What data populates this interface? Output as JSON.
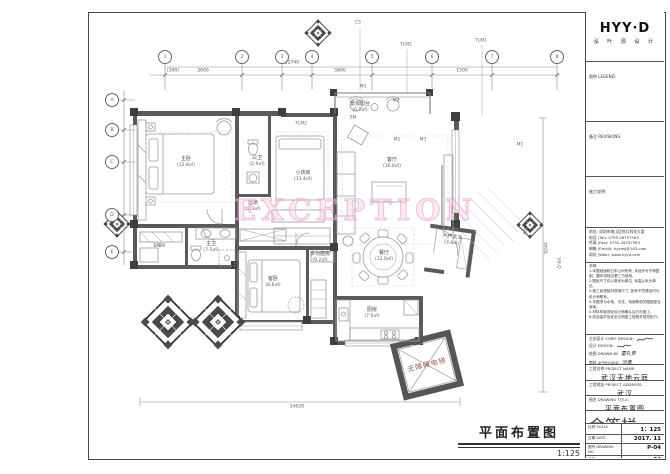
{
  "sheet": {
    "watermark": "EXCEPTION",
    "plan_title": "平面布置图",
    "plan_scale": "1:125"
  },
  "rooms": [
    {
      "name": "主卧",
      "area": "(12.8㎡)"
    },
    {
      "name": "公卫",
      "area": "(2.9㎡)"
    },
    {
      "name": "小孩房",
      "area": "(13.4㎡)"
    },
    {
      "name": "景观阳台",
      "area": "(6.1㎡)"
    },
    {
      "name": "客厅",
      "area": "(16.0㎡)"
    },
    {
      "name": "餐厅",
      "area": "(12.0㎡)"
    },
    {
      "name": "入户玄关",
      "area": "(3.8㎡)"
    },
    {
      "name": "厨房",
      "area": "(7.0㎡)"
    },
    {
      "name": "主卫",
      "area": "(7.5㎡)"
    },
    {
      "name": "客卧",
      "area": "(8.6㎡)"
    },
    {
      "name": "多功能房",
      "area": "(9.2㎡)"
    },
    {
      "name": "过道",
      "area": "(3.3㎡)"
    },
    {
      "name": "衣帽间",
      "area": ""
    }
  ],
  "elevator": {
    "label": "无障碍电梯"
  },
  "axis": {
    "c5": "C5",
    "tlm2_top": "TLM2",
    "tlm1": "TLM1",
    "m3_a": "M3",
    "m2_a": "M2",
    "sm": "SM",
    "tlm2_room": "TLM2",
    "m2_b": "M2",
    "m3_b": "M3",
    "m1": "M1",
    "w1": "W1",
    "vnq": "VN.Q"
  },
  "grid": {
    "top": [
      "1",
      "2",
      "3",
      "4",
      "5",
      "6",
      "7",
      "8"
    ],
    "left": [
      "A",
      "B",
      "C",
      "D",
      "E"
    ]
  },
  "dimensions": {
    "top_total": "12740",
    "seg1": "3600",
    "seg2": "5800",
    "seg3": "1500",
    "note": "(300)",
    "bottom_total": "14020",
    "right_total": "9240"
  },
  "titleblock": {
    "brand": "HYY·D",
    "brand_sub": "泓 叶 源 设 计",
    "legend_label": "图例 LEGEND:",
    "revisions_label": "备注 REVISIONS:",
    "notes_label": "施工说明:",
    "contact": {
      "address": "地址: 深圳市南山区蛇口科技大厦",
      "tel": "电话 (Tel): 0755-26757563",
      "fax": "传真 (Fax): 0755-26757563",
      "email": "邮箱 (Email): hyydsj@163.com",
      "web": "网址 (Web): www.hyyd.com"
    },
    "statement_label": "说明:",
    "statement_lines": [
      "1.本图纸版权归本公司所有, 未经许可不得复制、翻印或转交第三方使用。",
      "2.图纸尺寸均以毫米为单位, 标高以米为单位。",
      "3.施工前请核对现场尺寸, 如有不符请及时与设计师联系。",
      "4.本图须与水电、天花、地面等相关图纸配合使用。",
      "5.材料样板须经设计师确认后方可施工。",
      "6.成品保护及安全文明施工按相关规范执行。"
    ],
    "sign_rows": [
      {
        "label": "主创设计 CHIEF DESIGN:",
        "value": ""
      },
      {
        "label": "设计 DESIGN:",
        "value": ""
      },
      {
        "label": "绘图 DRAWN BY:",
        "value": "雷礼贵"
      },
      {
        "label": "审核 APPROVED:",
        "value": "洪勇"
      }
    ],
    "project_name_label": "工程名称 PROJECT NAME:",
    "project_name": "武汉天地云庭",
    "project_addr_label": "工程地址 PROJECT ADDRESS:",
    "project_addr": "武汉",
    "drawing_title_label": "图名 DRAWING TITLE:",
    "drawing_title": "平面布置图",
    "inner_label": "会签栏 INNER SIGNATURE:",
    "meta": [
      {
        "label": "比例 SCALE",
        "value": "1：125"
      },
      {
        "label": "日期 DATE.",
        "value": "2017. 11"
      },
      {
        "label": "图号 DRAWING NO.",
        "value": "P-04"
      },
      {
        "label": "页次",
        "value": "04"
      }
    ]
  }
}
